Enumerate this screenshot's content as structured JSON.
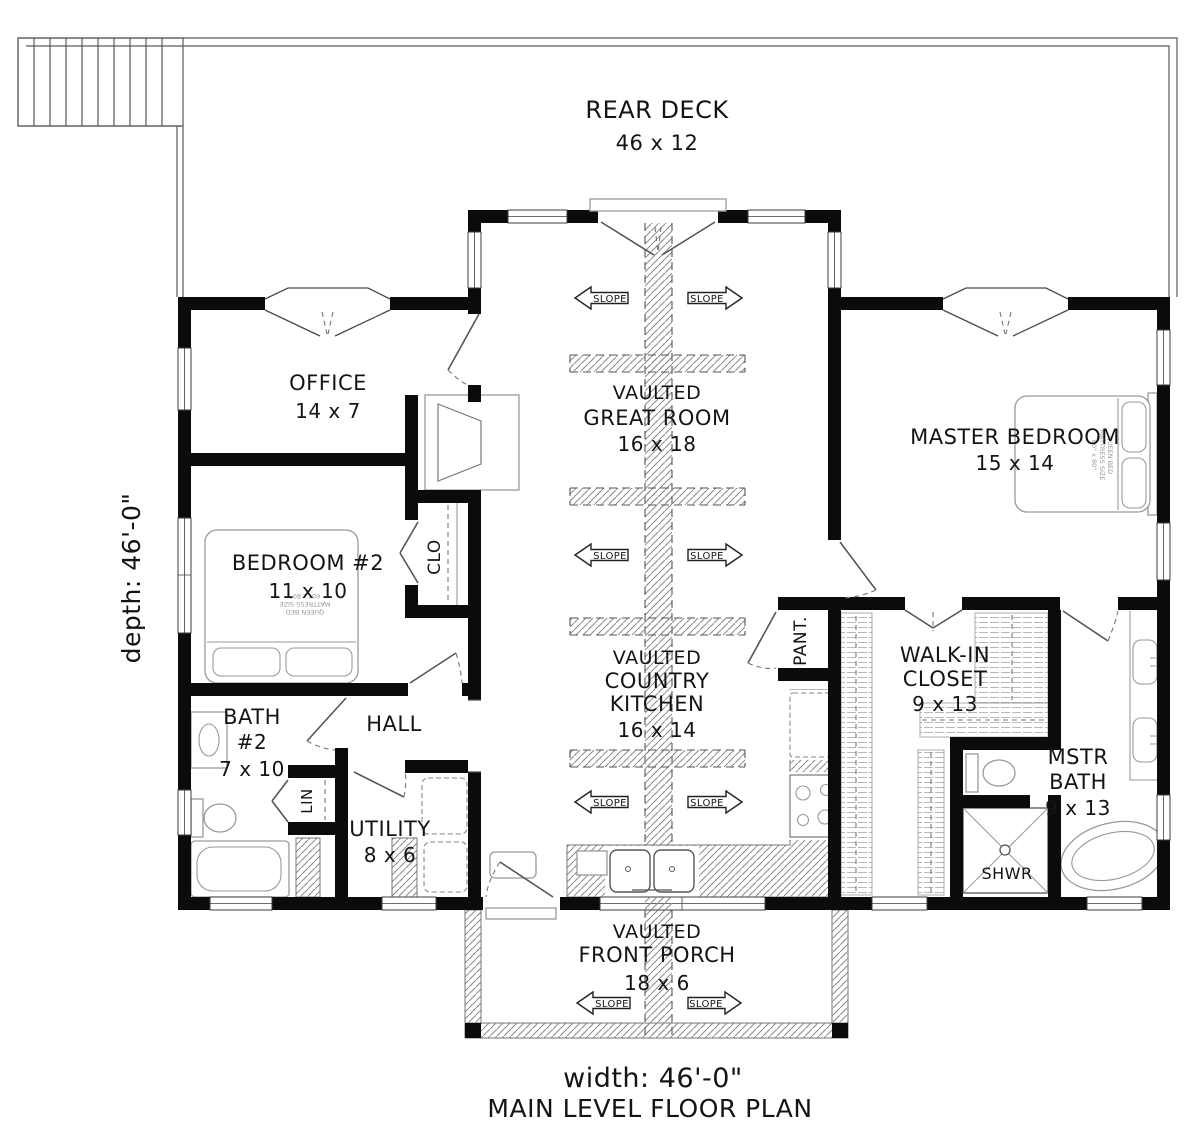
{
  "plan": {
    "colors": {
      "walls": "#0b0b0b",
      "linework": "#555555",
      "hatch": "#808080"
    },
    "depth_label": "depth: 46'-0\"",
    "slope": "SLOPE",
    "rear_deck": {
      "name": "REAR DECK",
      "dims": "46 x 12"
    },
    "office": {
      "name": "OFFICE",
      "dims": "14 x 7"
    },
    "great_room": {
      "line1": "VAULTED",
      "line2": "GREAT ROOM",
      "dims": "16 x 18"
    },
    "master_bedroom": {
      "name": "MASTER BEDROOM",
      "dims": "15 x 14"
    },
    "bedroom2": {
      "name": "BEDROOM #2",
      "dims": "11 x 10"
    },
    "clo": "CLO",
    "bath2": {
      "line1": "BATH",
      "line2": "#2",
      "dims": "7 x 10"
    },
    "hall": "HALL",
    "lin": "LIN",
    "utility": {
      "name": "UTILITY",
      "dims": "8 x 6"
    },
    "kitchen": {
      "line1": "VAULTED",
      "line2": "COUNTRY",
      "line3": "KITCHEN",
      "dims": "16 x 14"
    },
    "pantry": "PANT.",
    "walk_in": {
      "line1": "WALK-IN",
      "line2": "CLOSET",
      "dims": "9 x 13"
    },
    "master_bath": {
      "line1": "MSTR",
      "line2": "BATH",
      "dims": "9 x 13"
    },
    "shower": "SHWR",
    "front_porch": {
      "line1": "VAULTED",
      "line2": "FRONT PORCH",
      "dims": "18 x 6"
    },
    "bed_note": {
      "line1": "QUEEN BED",
      "line2": "MATTRESS SIZE",
      "line3": "60\" x 80\""
    },
    "footer": {
      "width_label": "width: 46'-0\"",
      "title": "MAIN LEVEL FLOOR PLAN"
    }
  }
}
